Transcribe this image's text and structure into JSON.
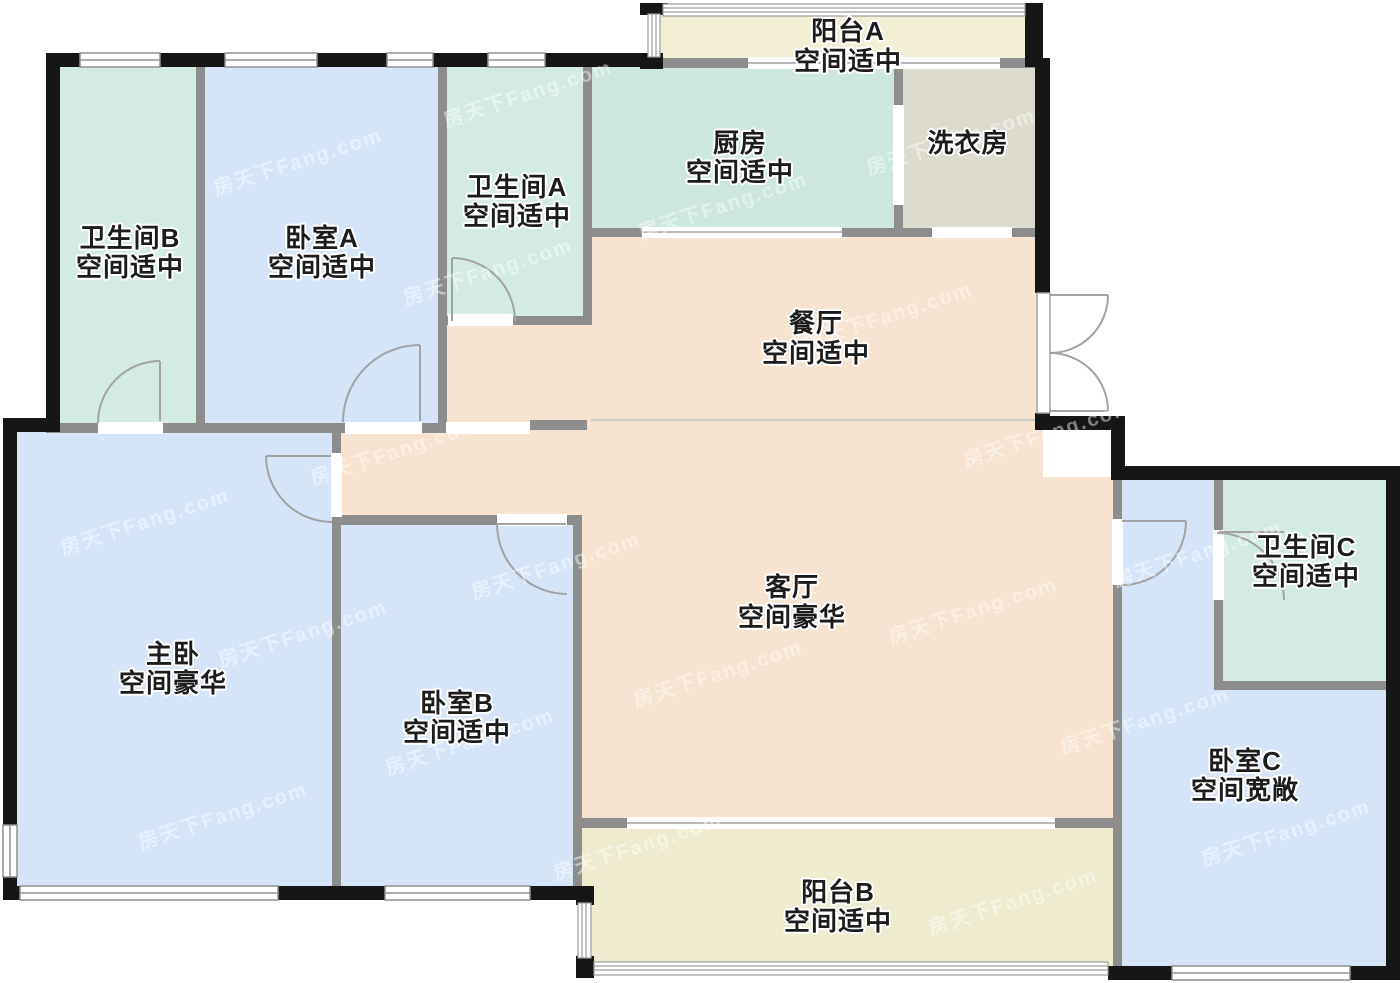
{
  "watermark": {
    "text": "房天下Fang.com"
  },
  "colors": {
    "wall_exterior": "#161616",
    "wall_interior": "#8d8d8d",
    "door_stroke": "#a3a3a3",
    "window_line": "#8f8f8f",
    "railing_line": "#9c9c9c",
    "divider_line": "#d2cfcb",
    "background": "#ffffff"
  },
  "rooms": [
    {
      "id": "balcony-a",
      "name": "阳台A",
      "descriptor": "空间适中",
      "color": "#f2efd6"
    },
    {
      "id": "kitchen",
      "name": "厨房",
      "descriptor": "空间适中",
      "color": "#cde7e0"
    },
    {
      "id": "laundry",
      "name": "洗衣房",
      "descriptor": "",
      "color": "#dcdbce"
    },
    {
      "id": "bathroom-a",
      "name": "卫生间A",
      "descriptor": "空间适中",
      "color": "#d4ebe2"
    },
    {
      "id": "bathroom-b",
      "name": "卫生间B",
      "descriptor": "空间适中",
      "color": "#d4ebe2"
    },
    {
      "id": "bedroom-a",
      "name": "卧室A",
      "descriptor": "空间适中",
      "color": "#d6e4f8"
    },
    {
      "id": "dining",
      "name": "餐厅",
      "descriptor": "空间适中",
      "color": "#f6e3d1"
    },
    {
      "id": "living",
      "name": "客厅",
      "descriptor": "空间豪华",
      "color": "#f6e3d1"
    },
    {
      "id": "master",
      "name": "主卧",
      "descriptor": "空间豪华",
      "color": "#d6e4f8"
    },
    {
      "id": "bedroom-b",
      "name": "卧室B",
      "descriptor": "空间适中",
      "color": "#d6e4f8"
    },
    {
      "id": "bathroom-c",
      "name": "卫生间C",
      "descriptor": "空间适中",
      "color": "#d4ebe2"
    },
    {
      "id": "bedroom-c",
      "name": "卧室C",
      "descriptor": "空间宽敞",
      "color": "#d6e4f8"
    },
    {
      "id": "balcony-b",
      "name": "阳台B",
      "descriptor": "空间适中",
      "color": "#eeebd0"
    }
  ]
}
